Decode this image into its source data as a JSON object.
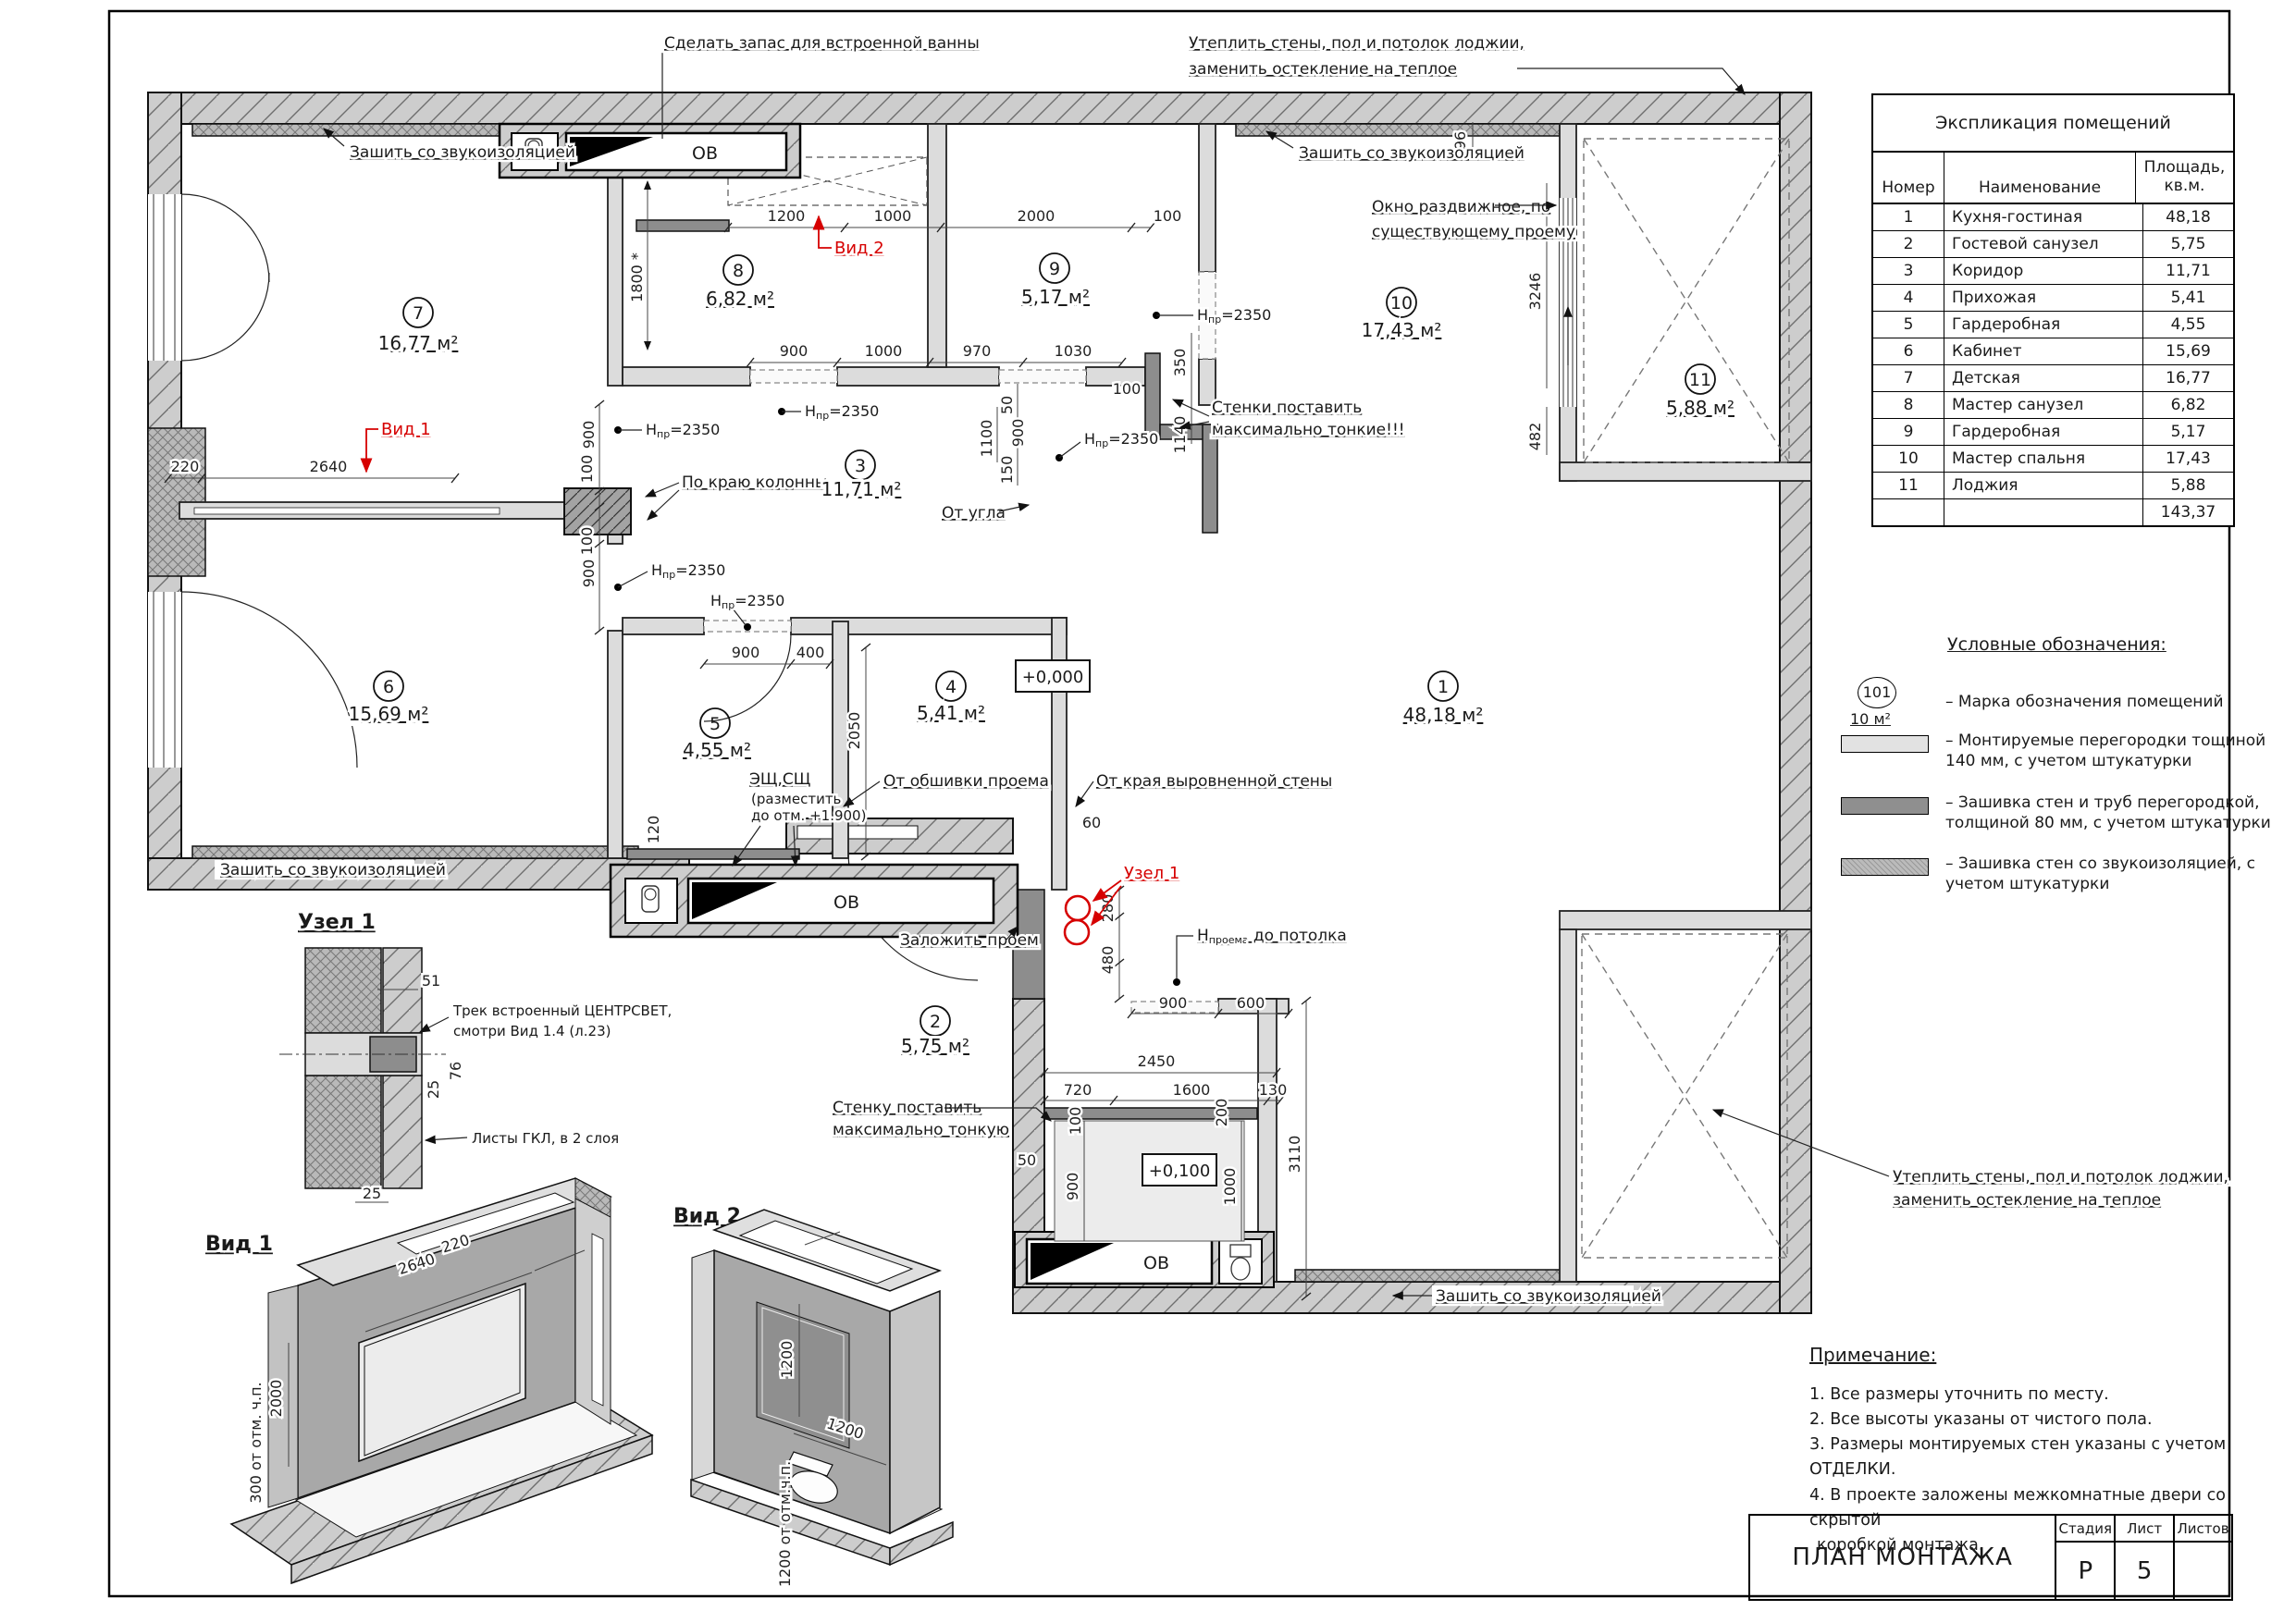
{
  "titleblock": {
    "title": "ПЛАН МОНТАЖА",
    "stage_label": "Стадия",
    "sheet_label": "Лист",
    "sheets_label": "Листов",
    "stage": "Р",
    "sheet": "5",
    "sheets": ""
  },
  "table": {
    "title": "Экспликация помещений",
    "col_num": "Номер",
    "col_name": "Наименование",
    "col_area1": "Площадь,",
    "col_area2": "кв.м.",
    "rows": [
      {
        "n": "1",
        "name": "Кухня-гостиная",
        "area": "48,18"
      },
      {
        "n": "2",
        "name": "Гостевой санузел",
        "area": "5,75"
      },
      {
        "n": "3",
        "name": "Коридор",
        "area": "11,71"
      },
      {
        "n": "4",
        "name": "Прихожая",
        "area": "5,41"
      },
      {
        "n": "5",
        "name": "Гардеробная",
        "area": "4,55"
      },
      {
        "n": "6",
        "name": "Кабинет",
        "area": "15,69"
      },
      {
        "n": "7",
        "name": "Детская",
        "area": "16,77"
      },
      {
        "n": "8",
        "name": "Мастер санузел",
        "area": "6,82"
      },
      {
        "n": "9",
        "name": "Гардеробная",
        "area": "5,17"
      },
      {
        "n": "10",
        "name": "Мастер спальня",
        "area": "17,43"
      },
      {
        "n": "11",
        "name": "Лоджия",
        "area": "5,88"
      }
    ],
    "total": "143,37"
  },
  "legend": {
    "title": "Условные обозначения:",
    "mark_num": "101",
    "mark_area": "10 м²",
    "i1": "– Марка обозначения помещений",
    "i2a": "– Монтируемые перегородки тощиной",
    "i2b": "140 мм, с учетом штукатурки",
    "i3a": "– Зашивка стен и труб перегородкой,",
    "i3b": "толщиной 80 мм, с учетом штукатурки",
    "i4a": "– Зашивка стен со звукоизоляцией, с",
    "i4b": "учетом штукатурки"
  },
  "notes": {
    "title": "Примечание:",
    "n1": "1. Все размеры уточнить по месту.",
    "n2": "2. Все высоты указаны от чистого пола.",
    "n3": "3. Размеры монтируемых стен указаны с учетом ОТДЕЛКИ.",
    "n4": "4. В проекте заложены межкомнатные двери со скрытой",
    "n5": "коробкой монтажа."
  },
  "plan": {
    "rooms": [
      {
        "num": "7",
        "area": "16,77 м²"
      },
      {
        "num": "8",
        "area": "6,82 м²"
      },
      {
        "num": "9",
        "area": "5,17 м²"
      },
      {
        "num": "10",
        "area": "17,43 м²"
      },
      {
        "num": "11",
        "area": "5,88 м²"
      },
      {
        "num": "3",
        "area": "11,71 м²"
      },
      {
        "num": "6",
        "area": "15,69 м²"
      },
      {
        "num": "5",
        "area": "4,55 м²"
      },
      {
        "num": "4",
        "area": "5,41 м²"
      },
      {
        "num": "1",
        "area": "48,18 м²"
      },
      {
        "num": "2",
        "area": "5,75 м²"
      }
    ],
    "levels": {
      "zero": "+0,000",
      "p100": "+0,100"
    },
    "labels": {
      "ov": "ОВ",
      "bath": "Сделать запас для встроенной ванны",
      "sound": "Зашить со звукоизоляцией",
      "warm1": "Утеплить стены, пол и потолок лоджии,",
      "warm2": "заменить остекление на теплое",
      "win1": "Окно раздвижное, по",
      "win2": "существующему проему",
      "thinw1": "Стенки поставить",
      "thinw2": "максимально тонкие!!!",
      "thin1": "Стенку поставить",
      "thin2": "максимально тонкую",
      "coledge": "По краю колонны",
      "corner": "От угла",
      "trim": "От обшивки проема",
      "edge": "От края выровненной стены",
      "fill": "Заложить проем",
      "esch1": "ЭЩ,СЩ",
      "esch2": "(разместить",
      "esch3": "до отм. +1.900)",
      "track1": "Трек встроенный ЦЕНТРСВЕТ,",
      "track2": "смотри Вид 1.4 (л.23)",
      "gkl": "Листы ГКЛ, в 2 слоя",
      "hm": "H",
      "hs": "пр",
      "hv": "=2350",
      "hpm": "Н",
      "hps": "проема",
      "hpr": " до потолка",
      "view1": "Вид 1",
      "view2": "Вид 2",
      "node1": "Узел 1"
    },
    "dims": {
      "25": "25",
      "50": "50",
      "51": "51",
      "60": "60",
      "76": "76",
      "96": "96",
      "100": "100",
      "120": "120",
      "130": "130",
      "150": "150",
      "200": "200",
      "220": "220",
      "280": "280",
      "350": "350",
      "400": "400",
      "480": "480",
      "482": "482",
      "600": "600",
      "720": "720",
      "900": "900",
      "970": "970",
      "1000": "1000",
      "1030": "1030",
      "1100": "1100",
      "1140": "1140",
      "1200": "1200",
      "1600": "1600",
      "2000": "2000",
      "2050": "2050",
      "2450": "2450",
      "2640": "2640",
      "3110": "3110",
      "3246": "3246",
      "d1800": "1800 *",
      "v300": "300 от отм. ч.п.",
      "v1200": "1200 от отм.ч.п."
    }
  }
}
